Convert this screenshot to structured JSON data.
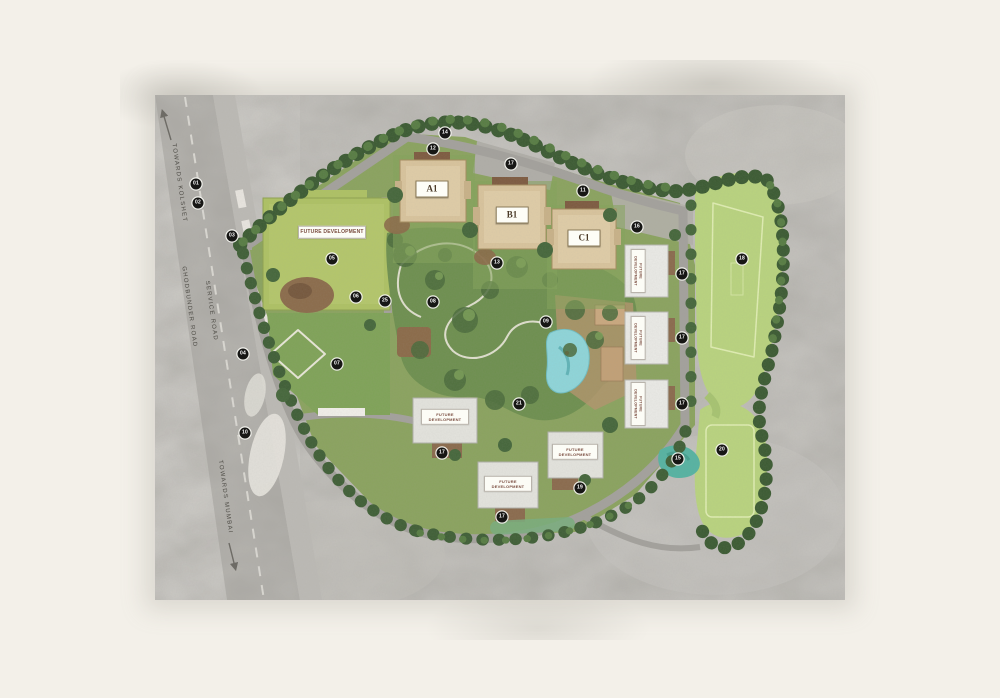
{
  "plan": {
    "towers": [
      {
        "text": "A1",
        "x": 277,
        "y": 94
      },
      {
        "text": "B1",
        "x": 357,
        "y": 120
      },
      {
        "text": "C1",
        "x": 429,
        "y": 143
      }
    ],
    "future_development": [
      {
        "text": "FUTURE DEVELOPMENT",
        "x": 177,
        "y": 137,
        "w": 64,
        "fs": 5,
        "angle": 0
      },
      {
        "text": "FUTURE DEVELOPMENT",
        "x": 290,
        "y": 322,
        "w": 44,
        "fs": 4,
        "angle": 0
      },
      {
        "text": "FUTURE DEVELOPMENT",
        "x": 353,
        "y": 389,
        "w": 44,
        "fs": 4,
        "angle": 0
      },
      {
        "text": "FUTURE DEVELOPMENT",
        "x": 420,
        "y": 357,
        "w": 42,
        "fs": 4,
        "angle": 0
      },
      {
        "text": "FUTURE DEVELOPMENT",
        "x": 483,
        "y": 176,
        "w": 40,
        "fs": 3.6,
        "angle": 90
      },
      {
        "text": "FUTURE DEVELOPMENT",
        "x": 483,
        "y": 243,
        "w": 40,
        "fs": 3.6,
        "angle": 90
      },
      {
        "text": "FUTURE DEVELOPMENT",
        "x": 483,
        "y": 309,
        "w": 40,
        "fs": 3.6,
        "angle": 90
      }
    ],
    "road_labels": [
      {
        "text": "TOWARDS KOLSHET",
        "x": 24,
        "y": 88,
        "angle": 82
      },
      {
        "text": "GHODBUNDER ROAD",
        "x": 34,
        "y": 212,
        "angle": 82
      },
      {
        "text": "SERVICE ROAD",
        "x": 56,
        "y": 216,
        "angle": 82
      },
      {
        "text": "TOWARDS MUMBAI",
        "x": 70,
        "y": 402,
        "angle": 82
      }
    ],
    "markers": [
      {
        "n": "01",
        "x": 41,
        "y": 89
      },
      {
        "n": "02",
        "x": 43,
        "y": 108
      },
      {
        "n": "03",
        "x": 77,
        "y": 141
      },
      {
        "n": "04",
        "x": 88,
        "y": 259
      },
      {
        "n": "10",
        "x": 90,
        "y": 338
      },
      {
        "n": "05",
        "x": 177,
        "y": 164
      },
      {
        "n": "06",
        "x": 201,
        "y": 202
      },
      {
        "n": "25",
        "x": 230,
        "y": 206
      },
      {
        "n": "07",
        "x": 182,
        "y": 269
      },
      {
        "n": "08",
        "x": 278,
        "y": 207
      },
      {
        "n": "12",
        "x": 278,
        "y": 54
      },
      {
        "n": "14",
        "x": 290,
        "y": 38
      },
      {
        "n": "17",
        "x": 356,
        "y": 69
      },
      {
        "n": "11",
        "x": 428,
        "y": 96
      },
      {
        "n": "16",
        "x": 482,
        "y": 132
      },
      {
        "n": "13",
        "x": 342,
        "y": 168
      },
      {
        "n": "09",
        "x": 391,
        "y": 227
      },
      {
        "n": "21",
        "x": 364,
        "y": 309
      },
      {
        "n": "17",
        "x": 527,
        "y": 179
      },
      {
        "n": "17",
        "x": 527,
        "y": 243
      },
      {
        "n": "17",
        "x": 527,
        "y": 309
      },
      {
        "n": "18",
        "x": 587,
        "y": 164
      },
      {
        "n": "15",
        "x": 523,
        "y": 364
      },
      {
        "n": "20",
        "x": 567,
        "y": 355
      },
      {
        "n": "17",
        "x": 287,
        "y": 358
      },
      {
        "n": "17",
        "x": 347,
        "y": 422
      },
      {
        "n": "19",
        "x": 425,
        "y": 393
      }
    ],
    "colors": {
      "page_background": "#f3f0e9",
      "concrete": "#b3b1ac",
      "road": "#a8a6a1",
      "parcel_green": "#aec263",
      "lawn_green": "#7fa357",
      "garden_green": "#6d8f4e",
      "field_green": "#b9d47e",
      "tree_dark": "#3a5a31",
      "tower_tan": "#d9c49c",
      "roof_brown": "#7d5a3f",
      "pool_blue": "#8ed6da",
      "pond_teal": "#55b3a2",
      "marker_black": "#171715"
    }
  }
}
